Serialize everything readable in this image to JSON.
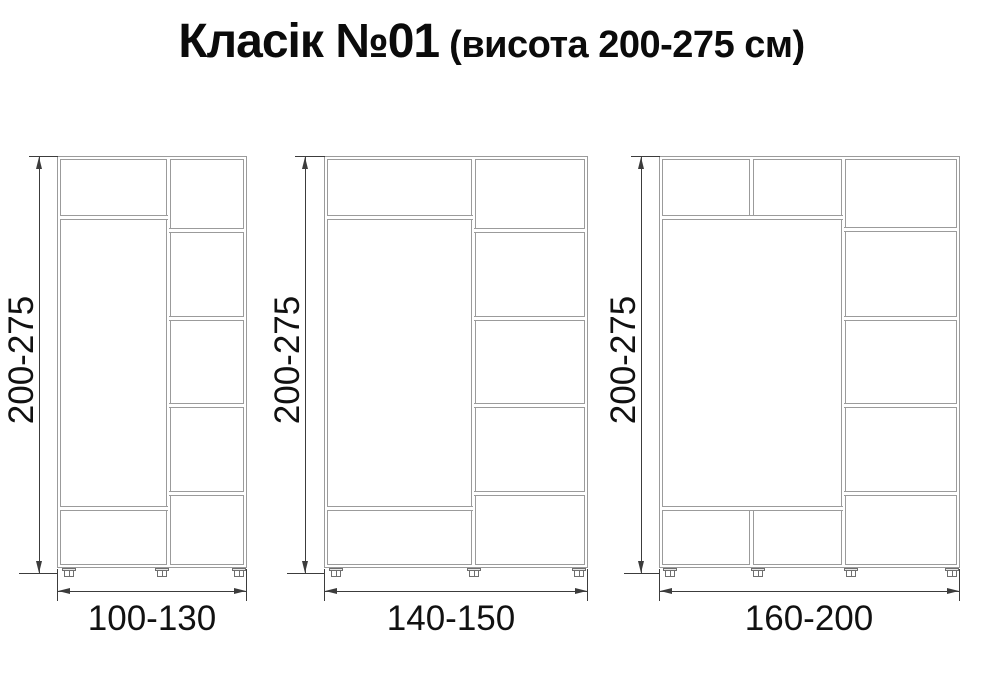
{
  "title": {
    "main": "Класік №01",
    "sub": " (висота 200-275 см)"
  },
  "cabinets": [
    {
      "height_label": "200-275",
      "width_label": "100-130"
    },
    {
      "height_label": "200-275",
      "width_label": "140-150"
    },
    {
      "height_label": "200-275",
      "width_label": "160-200"
    }
  ],
  "colors": {
    "background": "#ffffff",
    "cabinet_outline": "#9b9b9b",
    "dimension_line": "#3c3c3c",
    "text": "#111111"
  }
}
